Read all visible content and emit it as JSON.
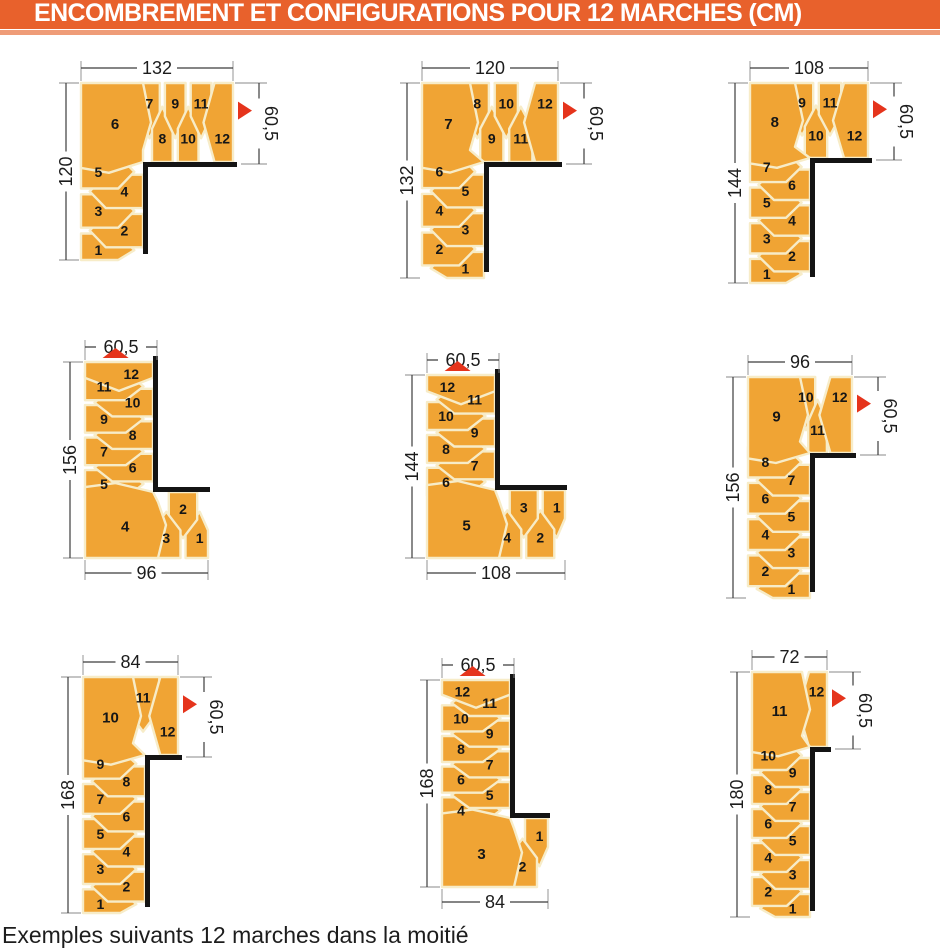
{
  "header": {
    "title": "ENCOMBREMENT ET CONFIGURATIONS POUR 12 MARCHES (CM)"
  },
  "caption_partial": "Exemples suivants 12 marches dans la moitié",
  "colors": {
    "header_bg": "#E8612C",
    "header_band": "#EF9C78",
    "step_orange": "#F0A434",
    "seam": "#F7ECC8",
    "wall": "#141414",
    "dim_line": "#3c3c3c",
    "witness_line": "#8a8a8a",
    "dim_text": "#1c1c1c",
    "number": "#161616",
    "arrow_red": "#E5341C"
  },
  "diagrams": [
    {
      "id": 1,
      "orientation": "A",
      "arrow": "right",
      "dims": {
        "top": "132",
        "left": "120",
        "side": "60,5"
      },
      "entry_steps": [
        1,
        2,
        3,
        4,
        5
      ],
      "corner_step": 6,
      "exit_steps": [
        7,
        8,
        9,
        10,
        11,
        12
      ]
    },
    {
      "id": 2,
      "orientation": "A",
      "arrow": "right",
      "dims": {
        "top": "120",
        "left": "132",
        "side": "60,5"
      },
      "entry_steps": [
        1,
        2,
        3,
        4,
        5,
        6
      ],
      "corner_step": 7,
      "exit_steps": [
        8,
        9,
        10,
        11,
        12
      ]
    },
    {
      "id": 3,
      "orientation": "A",
      "arrow": "right",
      "dims": {
        "top": "108",
        "left": "144",
        "side": "60,5"
      },
      "entry_steps": [
        1,
        2,
        3,
        4,
        5,
        6,
        7
      ],
      "corner_step": 8,
      "exit_steps": [
        9,
        10,
        11,
        12
      ]
    },
    {
      "id": 4,
      "orientation": "B",
      "arrow": "up",
      "dims": {
        "top": "60,5",
        "left": "156",
        "bottom": "96"
      },
      "entry_steps": [
        1,
        2,
        3
      ],
      "corner_step": 4,
      "exit_steps": [
        5,
        6,
        7,
        8,
        9,
        10,
        11,
        12
      ]
    },
    {
      "id": 5,
      "orientation": "B",
      "arrow": "up",
      "dims": {
        "top": "60,5",
        "left": "144",
        "bottom": "108"
      },
      "entry_steps": [
        1,
        2,
        3,
        4
      ],
      "corner_step": 5,
      "exit_steps": [
        6,
        7,
        8,
        9,
        10,
        11,
        12
      ]
    },
    {
      "id": 6,
      "orientation": "A",
      "arrow": "right",
      "dims": {
        "top": "96",
        "left": "156",
        "side": "60,5"
      },
      "entry_steps": [
        1,
        2,
        3,
        4,
        5,
        6,
        7,
        8
      ],
      "corner_step": 9,
      "exit_steps": [
        10,
        11,
        12
      ]
    },
    {
      "id": 7,
      "orientation": "A",
      "arrow": "right",
      "dims": {
        "top": "84",
        "left": "168",
        "side": "60,5"
      },
      "entry_steps": [
        1,
        2,
        3,
        4,
        5,
        6,
        7,
        8,
        9
      ],
      "corner_step": 10,
      "exit_steps": [
        11,
        12
      ]
    },
    {
      "id": 8,
      "orientation": "B",
      "arrow": "up",
      "dims": {
        "top": "60,5",
        "left": "168",
        "bottom": "84"
      },
      "entry_steps": [
        1,
        2
      ],
      "corner_step": 3,
      "exit_steps": [
        4,
        5,
        6,
        7,
        8,
        9,
        10,
        11,
        12
      ]
    },
    {
      "id": 9,
      "orientation": "A",
      "arrow": "right",
      "dims": {
        "top": "72",
        "left": "180",
        "side": "60,5"
      },
      "entry_steps": [
        1,
        2,
        3,
        4,
        5,
        6,
        7,
        8,
        9,
        10
      ],
      "corner_step": 11,
      "exit_steps": [
        12
      ]
    }
  ]
}
